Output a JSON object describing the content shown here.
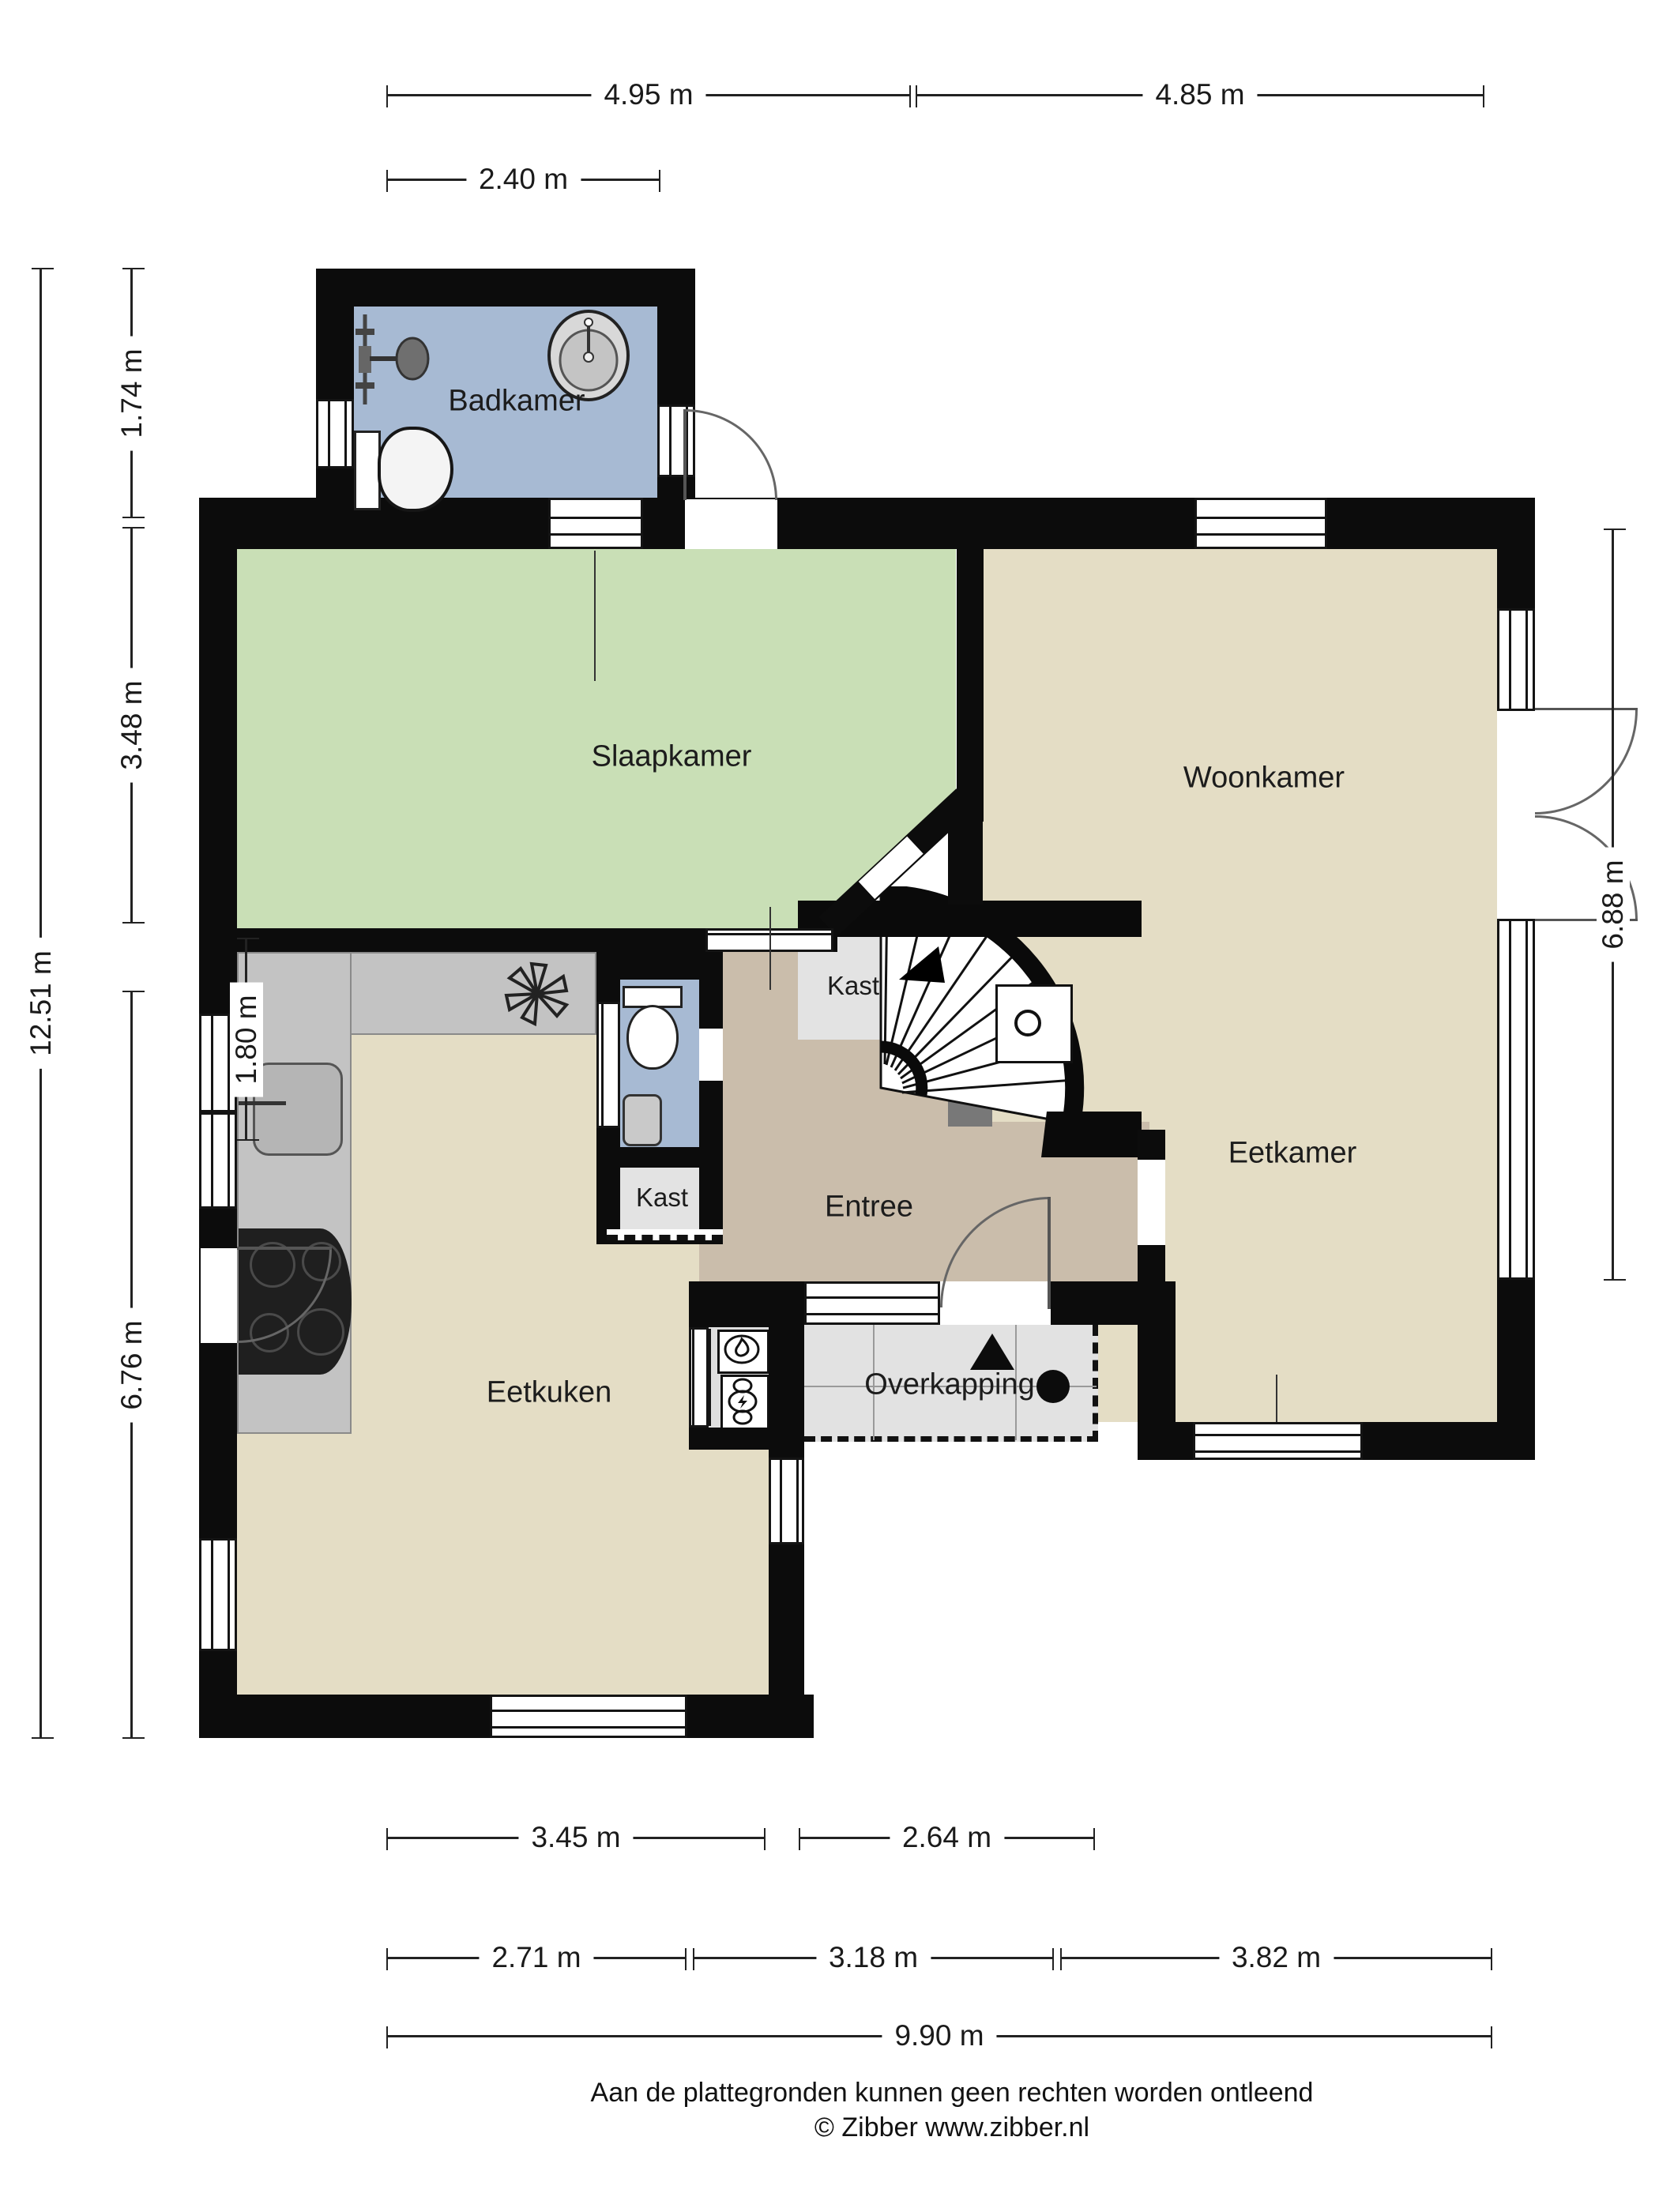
{
  "rooms": {
    "badkamer": "Badkamer",
    "slaapkamer": "Slaapkamer",
    "woonkamer": "Woonkamer",
    "eetkamer": "Eetkamer",
    "entree": "Entree",
    "kast_stair": "Kast",
    "kast_hal": "Kast",
    "eetkuken": "Eetkuken",
    "overkapping": "Overkapping"
  },
  "dims": {
    "top_left": "4.95 m",
    "top_right": "4.85 m",
    "badkamer_width": "2.40 m",
    "left_total": "12.51 m",
    "badkamer_height": "1.74 m",
    "slaapkamer_height": "3.48 m",
    "wc_height": "1.80 m",
    "eetkuken_height": "6.76 m",
    "right_height": "6.88 m",
    "bottom_eetkuken": "3.45 m",
    "bottom_overkapping": "2.64 m",
    "bottom_left2": "2.71 m",
    "bottom_mid2": "3.18 m",
    "bottom_right2": "3.82 m",
    "bottom_total": "9.90 m"
  },
  "footer": {
    "line1": "Aan de plattegronden kunnen geen rechten worden ontleend",
    "line2": "© Zibber www.zibber.nl"
  },
  "colors": {
    "wall": "#0c0c0c",
    "bathroom_blue": "#a7bad3",
    "bedroom_green": "#c9dfb6",
    "living_beige": "#e4ddc5",
    "entry_brown": "#cabdab",
    "closet_gray": "#e3e3e3",
    "canopy_gray": "#e2e2e2",
    "counter_gray": "#c3c3c3"
  }
}
